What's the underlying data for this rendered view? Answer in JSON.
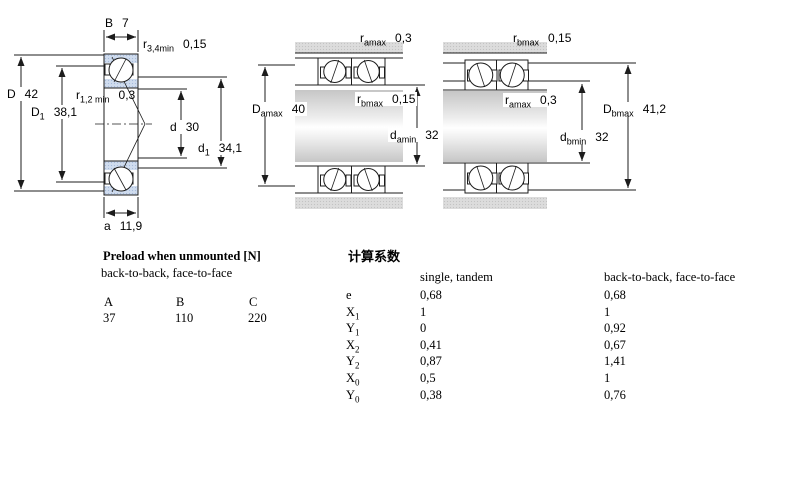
{
  "drawing": {
    "left": {
      "b": {
        "sym": "B",
        "val": "7"
      },
      "r34": {
        "sym": "r",
        "sub": "3,4min",
        "val": "0,15"
      },
      "D": {
        "sym": "D",
        "val": "42"
      },
      "D1": {
        "sym": "D",
        "sub": "1",
        "val": "38,1"
      },
      "r12": {
        "sym": "r",
        "sub": "1,2 min",
        "val": "0,3"
      },
      "d": {
        "sym": "d",
        "val": "30"
      },
      "d1": {
        "sym": "d",
        "sub": "1",
        "val": "34,1"
      },
      "a": {
        "sym": "a",
        "val": "11,9"
      }
    },
    "middle": {
      "ramax": {
        "sym": "r",
        "sub": "amax",
        "val": "0,3"
      },
      "Damax": {
        "sym": "D",
        "sub": "amax",
        "val": "40"
      },
      "rbmax": {
        "sym": "r",
        "sub": "bmax",
        "val": "0,15"
      },
      "damin": {
        "sym": "d",
        "sub": "amin",
        "val": "32"
      }
    },
    "right": {
      "rbmax": {
        "sym": "r",
        "sub": "bmax",
        "val": "0,15"
      },
      "ramax": {
        "sym": "r",
        "sub": "amax",
        "val": "0,3"
      },
      "Dbmax": {
        "sym": "D",
        "sub": "bmax",
        "val": "41,2"
      },
      "dbmin": {
        "sym": "d",
        "sub": "bmin",
        "val": "32"
      }
    }
  },
  "preload": {
    "title": "Preload when unmounted [N]",
    "subtitle": "back-to-back, face-to-face",
    "columns": [
      "A",
      "B",
      "C"
    ],
    "values": [
      "37",
      "110",
      "220"
    ]
  },
  "factors": {
    "title": "计算系数",
    "col_single": "single, tandem",
    "col_paired": "back-to-back, face-to-face",
    "rows": [
      {
        "sym": "e",
        "sub": "",
        "single": "0,68",
        "paired": "0,68"
      },
      {
        "sym": "X",
        "sub": "1",
        "single": "1",
        "paired": "1"
      },
      {
        "sym": "Y",
        "sub": "1",
        "single": "0",
        "paired": "0,92"
      },
      {
        "sym": "X",
        "sub": "2",
        "single": "0,41",
        "paired": "0,67"
      },
      {
        "sym": "Y",
        "sub": "2",
        "single": "0,87",
        "paired": "1,41"
      },
      {
        "sym": "X",
        "sub": "0",
        "single": "0,5",
        "paired": "1"
      },
      {
        "sym": "Y",
        "sub": "0",
        "single": "0,38",
        "paired": "0,76"
      }
    ]
  },
  "colors": {
    "ring_blue": "#cfdcee",
    "housing_gray": "#dcdcdc",
    "line": "#1c1c1c"
  }
}
